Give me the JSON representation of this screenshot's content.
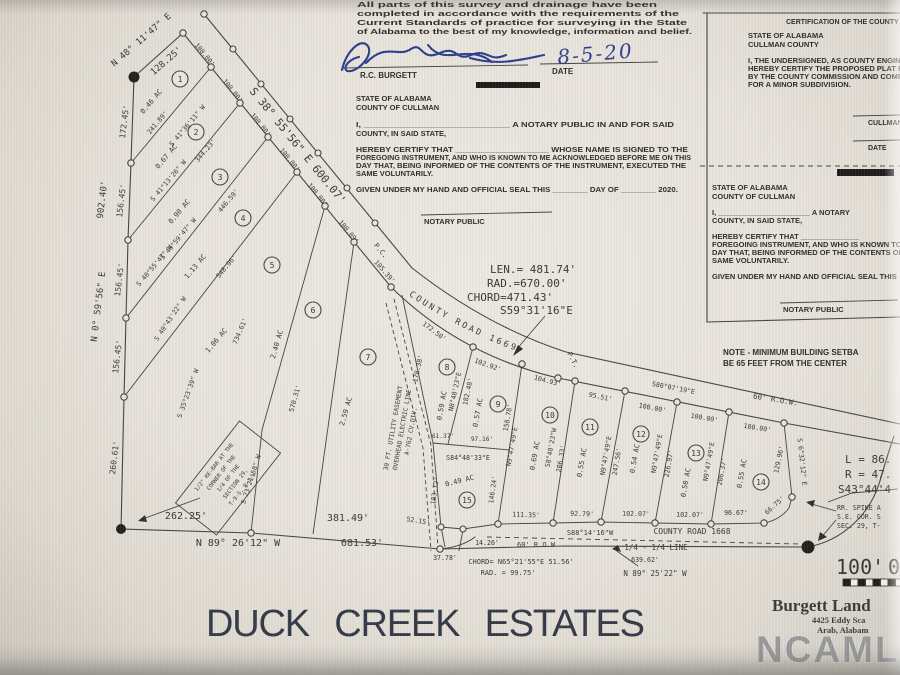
{
  "plat": {
    "title": "DUCK CREEK ESTATES",
    "watermark": "NCAMLS",
    "surveyor_block": {
      "line1": "All parts of this survey and drainage have been",
      "line2": "completed in accordance with the requirements of the",
      "line3": "Current Standards of practice for surveying in the State",
      "line4": "of Alabama to the best of my knowledge, information and belief.",
      "surveyor_name": "R.C. BURGETT",
      "date_label": "DATE",
      "date_value": "8-5-20"
    },
    "notary_left": {
      "state": "STATE OF ALABAMA",
      "county": "COUNTY OF CULLMAN",
      "l1": "I, _____________________________ A NOTARY PUBLIC IN AND FOR SAID",
      "l2": "COUNTY, IN SAID STATE,",
      "l3": "HEREBY CERTIFY THAT ____________________ WHOSE NAME IS SIGNED TO THE",
      "l4": "FOREGOING INSTRUMENT, AND WHO IS KNOWN TO ME ACKNOWLEDGED BEFORE ME ON THIS",
      "l5": "DAY THAT, BEING INFORMED OF THE CONTENTS OF THE INSTRUMENT, EXECUTED THE",
      "l6": "SAME VOLUNTARILY.",
      "l7": "GIVEN UNDER MY HAND AND OFFICIAL SEAL THIS ________ DAY OF ________ 2020.",
      "sig_label": "NOTARY PUBLIC"
    },
    "county_cert": {
      "title": "CERTIFICATION OF THE COUNTY",
      "state": "STATE OF ALABAMA",
      "county": "CULLMAN COUNTY",
      "l1": "I, THE UNDERSIGNED, AS COUNTY ENGINEER",
      "l2": "HEREBY CERTIFY THE PROPOSED PLAT F",
      "l3": "BY THE COUNTY COMMISSION AND COMP",
      "l4": "FOR A MINOR SUBDIVISION.",
      "sig1_label": "CULLMAN",
      "sig2_label": "DATE"
    },
    "notary_right": {
      "state": "STATE OF ALABAMA",
      "county": "COUNTY OF CULLMAN",
      "l1": "I, ______________________ A NOTARY",
      "l2": "COUNTY, IN SAID STATE,",
      "l3": "HEREBY CERTIFY THAT ______________",
      "l4": "FOREGOING INSTRUMENT, AND WHO IS KNOWN TO",
      "l5": "DAY THAT, BEING INFORMED OF THE CONTENTS OF",
      "l6": "SAME VOLUNTARILY.",
      "l7": "GIVEN UNDER MY HAND AND OFFICIAL SEAL THIS",
      "sig_label": "NOTARY PUBLIC"
    },
    "note": {
      "l1": "NOTE - MINIMUM BUILDING SETBA",
      "l2": "BE 65 FEET FROM THE CENTER"
    },
    "curve": {
      "len": "LEN.= 481.74'",
      "rad": "RAD.=670.00'",
      "chord": "CHORD=471.43'",
      "bearing": "S59°31'16\"E"
    },
    "curve2": {
      "chord": "CHORD= N65°21'55\"E  51.56'",
      "rad": "RAD. = 99.75'"
    },
    "curve3": {
      "l": "L = 86.",
      "r": "R = 47.",
      "bearing": "S43°44'4"
    },
    "roads": {
      "r1669": "COUNTY ROAD 1669",
      "r1668": "COUNTY ROAD 1668",
      "row_top": "60' R.O.W.",
      "row_bottom": "60' R.O.W",
      "quarter": "1/4 - 1/4 LINE"
    },
    "markers": {
      "pc": "P.C.",
      "pt": "P.T."
    },
    "easement": [
      "30 FT. UTILITY EASEMENT",
      "OVERHEAD ELECTRIC LINE",
      "A-762 CV.DIV."
    ],
    "monuments": {
      "rebar": [
        "1/2\" RE-BAR AT THE",
        "CORNER OF THE",
        "1/4 OF THE",
        "SECTION 29,",
        "T-9-S, R-1-W"
      ],
      "rr_spike": [
        "RR. SPIKE A",
        "S.E. COR. S",
        "SEC. 29, T-"
      ]
    },
    "scale": {
      "label": "100'",
      "zero": "0"
    },
    "firm": {
      "name": "Burgett Land",
      "addr1": "4425 Eddy Sca",
      "addr2": "Arab, Alabam"
    },
    "lots": [
      {
        "num": "1",
        "acres": "0.46 AC"
      },
      {
        "num": "2",
        "acres": "0.67 AC"
      },
      {
        "num": "3",
        "acres": "0.90 AC"
      },
      {
        "num": "4",
        "acres": "1.13 AC"
      },
      {
        "num": "5",
        "acres": "1.06 AC"
      },
      {
        "num": "6",
        "acres": "2.40 AC"
      },
      {
        "num": "7",
        "acres": "2.59 AC"
      },
      {
        "num": "8",
        "acres": "0.59 AC"
      },
      {
        "num": "9",
        "acres": "0.57 AC"
      },
      {
        "num": "10",
        "acres": "0.69 AC"
      },
      {
        "num": "11",
        "acres": "0.55 AC"
      },
      {
        "num": "12",
        "acres": "0.54 AC"
      },
      {
        "num": "13",
        "acres": "0.50 AC"
      },
      {
        "num": "14",
        "acres": "0.55 AC"
      },
      {
        "num": "15",
        "acres": "0.49 AC"
      }
    ],
    "dims": {
      "n48": "N 48° 11'47\" E",
      "d128": "128.25'",
      "west_bearing": "N 0° 59'56\" E",
      "west_total": "902.40'",
      "w1": "172.45'",
      "w2": "156.45'",
      "w3": "156.45'",
      "w4": "156.45'",
      "w5": "260.61'",
      "road_bearing": "S 38° 55'56\" E   600.07'",
      "f100": "100.00'",
      "f100_09": "100.09'",
      "f105": "105.39'",
      "l12_b": "S 41°36'11\" W",
      "l12_d": "241.89'",
      "l23_b": "S 41°13'26\" W",
      "l23_d": "344.23'",
      "l34_b": "S 40°59'47\" W",
      "l34_d": "446.59'",
      "l45_b": "S 40°55'47\" W",
      "l45_d": "548.96'",
      "l56_b": "S 40°43'22\" W",
      "l56_d": "734.61'",
      "l67_d": "570.31'",
      "b3523": "S 35°23'39\" W",
      "b2321": "S 23°21'58\" W",
      "d26225": "262.25'",
      "d38149": "381.49'",
      "south_bearing": "N 89° 26'12\" W",
      "d68153": "681.53'",
      "d17250": "172.50'",
      "d17838": "178.38'",
      "d18312": "183.12'",
      "d14624": "146.24'",
      "d10292": "102.92'",
      "d10493": "104.93'",
      "d9551": "95.51'",
      "top_b": "S80°07'19\"E",
      "b848e": "N8°48'23\"E",
      "d18248": "182.48'",
      "d6137": "61.37'",
      "d9716": "97.16'",
      "b8448": "S84°48'33\"E",
      "d15878": "158.78'",
      "b947": "N9°47'49\"E",
      "d24756": "247.56'",
      "d22697": "226.97'",
      "d20637": "206.37'",
      "b848w": "S8°48'23\"W",
      "d20633": "206.33'",
      "d12996": "129.96'",
      "b632": "S 6°32'12\" E",
      "d9667": "96.67'",
      "d6675": "66.75'",
      "d11135": "111.35'",
      "d9279": "92.79'",
      "d10207": "102.07'",
      "b8814": "S88°14'16\"W",
      "d5215": "52.15'",
      "d3778": "37.78'",
      "d1426": "14.26'",
      "d63962": "639.62'",
      "b8925": "N 89° 25'22\" W"
    }
  }
}
